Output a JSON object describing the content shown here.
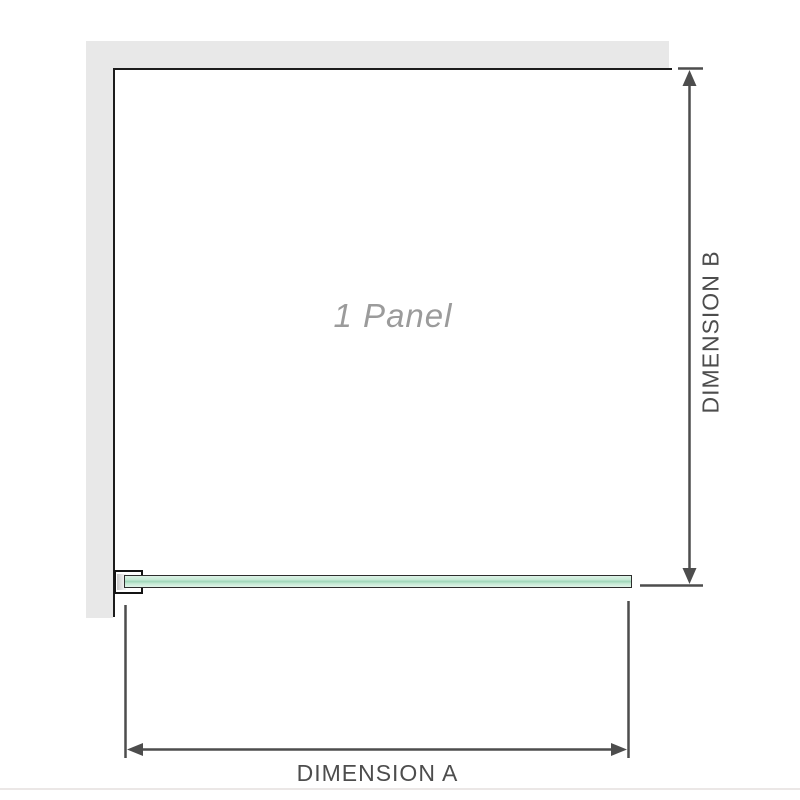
{
  "diagram": {
    "panel_label": "1 Panel",
    "dimension_a": {
      "label": "DIMENSION A"
    },
    "dimension_b": {
      "label": "DIMENSION B"
    }
  },
  "colors": {
    "wall": "#e8e8e8",
    "panel_border": "#1c1c1c",
    "dimension_line": "#4d4d4d",
    "dimension_label_text": "#4d4d4d",
    "panel_label_text": "#9b9b9b",
    "glass_fill_light": "#ddf2e7",
    "glass_fill_center": "#9ed6b9",
    "glass_border": "#2d2d2d",
    "bracket_border": "#141414",
    "bottom_separator": "#ebe7e6"
  }
}
